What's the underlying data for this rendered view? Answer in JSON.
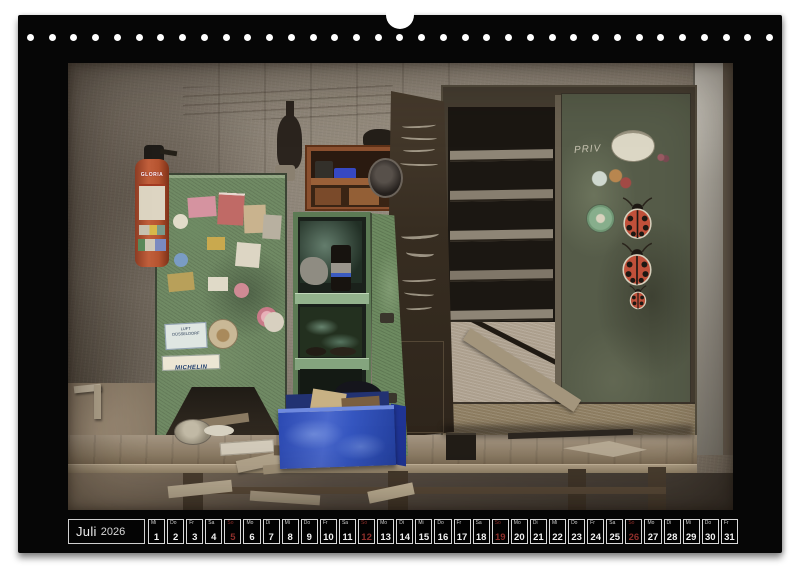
{
  "calendar": {
    "month": "Juli",
    "year": "2026",
    "days": [
      {
        "num": "1",
        "wd": "Mi"
      },
      {
        "num": "2",
        "wd": "Do"
      },
      {
        "num": "3",
        "wd": "Fr"
      },
      {
        "num": "4",
        "wd": "Sa"
      },
      {
        "num": "5",
        "wd": "So",
        "sunday": true
      },
      {
        "num": "6",
        "wd": "Mo"
      },
      {
        "num": "7",
        "wd": "Di"
      },
      {
        "num": "8",
        "wd": "Mi"
      },
      {
        "num": "9",
        "wd": "Do"
      },
      {
        "num": "10",
        "wd": "Fr"
      },
      {
        "num": "11",
        "wd": "Sa"
      },
      {
        "num": "12",
        "wd": "So",
        "sunday": true
      },
      {
        "num": "13",
        "wd": "Mo"
      },
      {
        "num": "14",
        "wd": "Di"
      },
      {
        "num": "15",
        "wd": "Mi"
      },
      {
        "num": "16",
        "wd": "Do"
      },
      {
        "num": "17",
        "wd": "Fr"
      },
      {
        "num": "18",
        "wd": "Sa"
      },
      {
        "num": "19",
        "wd": "So",
        "sunday": true
      },
      {
        "num": "20",
        "wd": "Mo"
      },
      {
        "num": "21",
        "wd": "Di"
      },
      {
        "num": "22",
        "wd": "Mi"
      },
      {
        "num": "23",
        "wd": "Do"
      },
      {
        "num": "24",
        "wd": "Fr"
      },
      {
        "num": "25",
        "wd": "Sa"
      },
      {
        "num": "26",
        "wd": "So",
        "sunday": true
      },
      {
        "num": "27",
        "wd": "Mo"
      },
      {
        "num": "28",
        "wd": "Di"
      },
      {
        "num": "29",
        "wd": "Mi"
      },
      {
        "num": "30",
        "wd": "Do"
      },
      {
        "num": "31",
        "wd": "Fr"
      }
    ]
  },
  "binding": {
    "holes": 35
  },
  "photo": {
    "texts": {
      "extinguisher_brand": "GLORIA",
      "tyre_sticker": "MICHELIN",
      "chalk_word": "PRIV",
      "sticker_line1": "LUFT",
      "sticker_line2": "DÜSSELDORF"
    }
  },
  "colors": {
    "page": "#ffffff",
    "sheet": "#060606",
    "sunday": "#8e2f2b",
    "weekday_text": "#f1f1f1",
    "extinguisher_red": "#b5532f",
    "cabinet_green": "#708a64",
    "shelf_green": "#5c7a54",
    "crate_blue": "#3a57c2",
    "ladybug_red": "#c0503a",
    "metal_gray": "#b2aea4",
    "bench_wood": "#8d7d66"
  }
}
